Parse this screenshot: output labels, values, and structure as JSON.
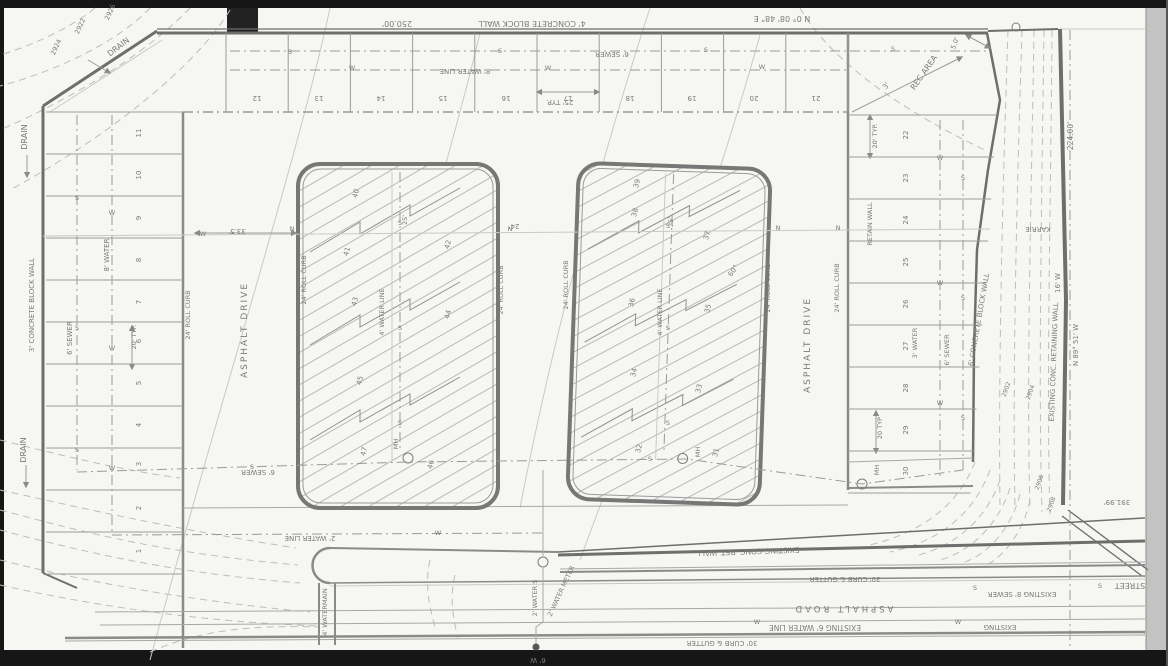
{
  "colors": {
    "paper": "#f6f6f3",
    "frame": "#161616",
    "margin": "#c3c3c3",
    "pencil": "#8c8c8c",
    "pencil_light": "#bdbdbd",
    "pencil_dark": "#5f5f5f"
  },
  "annotations": [
    {
      "id": "top-wall-label",
      "text": "4' CONCRETE BLOCK WALL",
      "x": 532,
      "y": 21,
      "r": 180,
      "s": 8
    },
    {
      "id": "top-wall-dim",
      "text": "250.00'",
      "x": 397,
      "y": 21,
      "r": 180,
      "s": 8
    },
    {
      "id": "top-bearing",
      "text": "N 0° 08' 48\" E",
      "x": 782,
      "y": 16,
      "r": 180,
      "s": 8
    },
    {
      "id": "top-sewer-label",
      "text": "6' SEWER",
      "x": 612,
      "y": 52,
      "r": 180,
      "s": 7
    },
    {
      "id": "top-water-label",
      "text": "8' WATER LINE",
      "x": 465,
      "y": 69,
      "r": 180,
      "s": 7
    },
    {
      "id": "top-dim-25typ",
      "text": "25' TYP.",
      "x": 560,
      "y": 100,
      "r": 180,
      "s": 7
    },
    {
      "id": "drain-nw-1",
      "text": "DRAIN",
      "x": 120,
      "y": 49,
      "r": -38,
      "s": 8
    },
    {
      "id": "drain-nw-2",
      "text": "DRAIN",
      "x": 27,
      "y": 137,
      "r": -90,
      "s": 8
    },
    {
      "id": "contour-2924",
      "text": "2924",
      "x": 58,
      "y": 48,
      "r": -65,
      "s": 6.5
    },
    {
      "id": "contour-2922",
      "text": "2922",
      "x": 82,
      "y": 27,
      "r": -65,
      "s": 6.5
    },
    {
      "id": "contour-2926",
      "text": "2926",
      "x": 112,
      "y": 13,
      "r": -65,
      "s": 6.5
    },
    {
      "id": "left-wall-label",
      "text": "3' CONCRETE BLOCK WALL",
      "x": 34,
      "y": 305,
      "r": -90,
      "s": 7
    },
    {
      "id": "left-sewer-label",
      "text": "6' SEWER",
      "x": 72,
      "y": 338,
      "r": -90,
      "s": 7
    },
    {
      "id": "left-water-label",
      "text": "8' WATER",
      "x": 109,
      "y": 255,
      "r": -90,
      "s": 7
    },
    {
      "id": "left-dim-20typ",
      "text": "20' TYP.",
      "x": 136,
      "y": 337,
      "r": -90,
      "s": 6.5
    },
    {
      "id": "drain-sw",
      "text": "DRAIN",
      "x": 26,
      "y": 450,
      "r": -90,
      "s": 8
    },
    {
      "id": "rec-area-label",
      "text": "REC AREA",
      "x": 926,
      "y": 74,
      "r": -55,
      "s": 8
    },
    {
      "id": "rec-dim-3",
      "text": "3'",
      "x": 888,
      "y": 87,
      "r": -55,
      "s": 7
    },
    {
      "id": "rec-dim-5",
      "text": "5.0'",
      "x": 957,
      "y": 44,
      "r": -70,
      "s": 6.5
    },
    {
      "id": "dim-224",
      "text": "224.00'",
      "x": 1073,
      "y": 136,
      "r": -90,
      "s": 7.5
    },
    {
      "id": "street-karrie",
      "text": "KARRIE",
      "x": 1038,
      "y": 227,
      "r": 180,
      "s": 7
    },
    {
      "id": "wall-6conc-label",
      "text": "6' CONCRETE BLOCK WALL",
      "x": 981,
      "y": 320,
      "r": -80,
      "s": 7
    },
    {
      "id": "ret-wall-ne-label",
      "text": "EXISTING CONC. RETAINING WALL",
      "x": 1056,
      "y": 362,
      "r": -88,
      "s": 7
    },
    {
      "id": "bearing-right",
      "text": "N 89° 51' W",
      "x": 1078,
      "y": 345,
      "r": -90,
      "s": 7
    },
    {
      "id": "dim-16w",
      "text": "16' W",
      "x": 1060,
      "y": 283,
      "r": -90,
      "s": 7
    },
    {
      "id": "contour-2902",
      "text": "2902",
      "x": 1008,
      "y": 390,
      "r": -70,
      "s": 6
    },
    {
      "id": "contour-2904",
      "text": "2904",
      "x": 1032,
      "y": 393,
      "r": -70,
      "s": 6
    },
    {
      "id": "right-water-label",
      "text": "3' WATER",
      "x": 917,
      "y": 343,
      "r": -90,
      "s": 6.5
    },
    {
      "id": "right-sewer-label",
      "text": "6' SEWER",
      "x": 949,
      "y": 350,
      "r": -90,
      "s": 6.5
    },
    {
      "id": "right-retain-label",
      "text": "RETAIN WALL",
      "x": 872,
      "y": 224,
      "r": -90,
      "s": 6.5
    },
    {
      "id": "right-dim-20a",
      "text": "20' TYP.",
      "x": 877,
      "y": 136,
      "r": -90,
      "s": 6.5
    },
    {
      "id": "right-dim-20b",
      "text": "20 TYP",
      "x": 882,
      "y": 428,
      "r": -90,
      "s": 6.5
    },
    {
      "id": "ret-wall-s-label",
      "text": "EXISTING CONC. RET. WALL",
      "x": 748,
      "y": 549,
      "r": 178,
      "s": 7.5
    },
    {
      "id": "curb-gutter-n",
      "text": "30' CURB & GUTTER",
      "x": 845,
      "y": 577,
      "r": 180,
      "s": 7
    },
    {
      "id": "asphalt-road-label",
      "text": "ASPHALT ROAD",
      "x": 843,
      "y": 606,
      "r": 180,
      "s": 8.5,
      "ls": 3
    },
    {
      "id": "exist-water-6",
      "text": "EXISTING 6' WATER LINE",
      "x": 815,
      "y": 625,
      "r": 180,
      "s": 7.5
    },
    {
      "id": "curb-gutter-s",
      "text": "30' CURB & GUTTER",
      "x": 722,
      "y": 641,
      "r": 180,
      "s": 7
    },
    {
      "id": "exist-sewer-8",
      "text": "EXISTING 8' SEWER",
      "x": 1022,
      "y": 592,
      "r": 180,
      "s": 7
    },
    {
      "id": "street-label",
      "text": "STREET",
      "x": 1130,
      "y": 583,
      "r": 180,
      "s": 8
    },
    {
      "id": "exist-w-label",
      "text": "EXISTING",
      "x": 1000,
      "y": 625,
      "r": 180,
      "s": 7
    },
    {
      "id": "dim-39199",
      "text": "391.99'",
      "x": 1117,
      "y": 500,
      "r": 180,
      "s": 7
    },
    {
      "id": "contour-2906",
      "text": "2906",
      "x": 1041,
      "y": 483,
      "r": -70,
      "s": 6
    },
    {
      "id": "contour-2908",
      "text": "2908",
      "x": 1053,
      "y": 505,
      "r": -70,
      "s": 6
    },
    {
      "id": "water-2-line",
      "text": "2' WATER LINE",
      "x": 310,
      "y": 536,
      "r": 180,
      "s": 7
    },
    {
      "id": "sewer-6-s",
      "text": "6' SEWER",
      "x": 258,
      "y": 470,
      "r": 180,
      "s": 7
    },
    {
      "id": "watermain-4",
      "text": "4' WATERMAIN",
      "x": 327,
      "y": 612,
      "r": -90,
      "s": 6.5
    },
    {
      "id": "water-2-s",
      "text": "2' WATER S",
      "x": 537,
      "y": 598,
      "r": -90,
      "s": 6.5
    },
    {
      "id": "water-meter-2",
      "text": "2' WATER METER",
      "x": 563,
      "y": 592,
      "r": -65,
      "s": 6.5
    },
    {
      "id": "tap-6w",
      "text": "6' W",
      "x": 538,
      "y": 658,
      "r": 180,
      "s": 7
    },
    {
      "id": "drive-west-label",
      "text": "ASPHALT DRIVE",
      "x": 247,
      "y": 330,
      "r": -90,
      "s": 9,
      "ls": 2
    },
    {
      "id": "drive-east-label",
      "text": "ASPHALT DRIVE",
      "x": 810,
      "y": 345,
      "r": -90,
      "s": 9,
      "ls": 2
    },
    {
      "id": "roll-curb-1",
      "text": "24' ROLL CURB",
      "x": 190,
      "y": 315,
      "r": -90,
      "s": 6.5
    },
    {
      "id": "roll-curb-2",
      "text": "24' ROLL CURB",
      "x": 306,
      "y": 280,
      "r": -90,
      "s": 6.5
    },
    {
      "id": "roll-curb-3",
      "text": "24' ROLL CURB",
      "x": 503,
      "y": 290,
      "r": -90,
      "s": 6.5
    },
    {
      "id": "roll-curb-4",
      "text": "24' ROLL CURB",
      "x": 568,
      "y": 285,
      "r": -90,
      "s": 6.5
    },
    {
      "id": "roll-curb-5",
      "text": "24' ROLL CURB",
      "x": 770,
      "y": 288,
      "r": -90,
      "s": 6.5
    },
    {
      "id": "roll-curb-6",
      "text": "24' ROLL CURB",
      "x": 839,
      "y": 288,
      "r": -90,
      "s": 6.5
    },
    {
      "id": "dim-335",
      "text": "33.5'",
      "x": 237,
      "y": 229,
      "r": 180,
      "s": 7
    },
    {
      "id": "dim-24",
      "text": "24'",
      "x": 514,
      "y": 224,
      "r": 180,
      "s": 7
    },
    {
      "id": "bldg-water-l",
      "text": "4' WATER LINE",
      "x": 384,
      "y": 312,
      "r": -90,
      "s": 6.5
    },
    {
      "id": "bldg-water-r",
      "text": "4' WATER LINE",
      "x": 662,
      "y": 312,
      "r": -90,
      "s": 6.5
    },
    {
      "id": "mh-1",
      "text": "MH",
      "x": 398,
      "y": 444,
      "r": -90,
      "s": 6.5
    },
    {
      "id": "mh-2",
      "text": "MH",
      "x": 700,
      "y": 452,
      "r": -90,
      "s": 6.5
    },
    {
      "id": "mh-3",
      "text": "MH",
      "x": 879,
      "y": 470,
      "r": -90,
      "s": 6.5
    },
    {
      "id": "angle-60",
      "text": "60°",
      "x": 735,
      "y": 272,
      "r": -55,
      "s": 7
    },
    {
      "id": "dim-25-bldg-l",
      "text": "25'",
      "x": 407,
      "y": 220,
      "r": -90,
      "s": 6.5
    },
    {
      "id": "dim-25-bldg-r",
      "text": "25'",
      "x": 673,
      "y": 222,
      "r": -90,
      "s": 6.5
    }
  ],
  "parking": {
    "left_stalls": [
      {
        "id": "stall-11",
        "text": "11",
        "x": 141,
        "y": 133,
        "r": -90,
        "s": 7
      },
      {
        "id": "stall-10",
        "text": "10",
        "x": 141,
        "y": 175,
        "r": -90,
        "s": 7
      },
      {
        "id": "stall-9",
        "text": "9",
        "x": 141,
        "y": 218,
        "r": -90,
        "s": 7
      },
      {
        "id": "stall-8",
        "text": "8",
        "x": 141,
        "y": 260,
        "r": -90,
        "s": 7
      },
      {
        "id": "stall-7",
        "text": "7",
        "x": 141,
        "y": 302,
        "r": -90,
        "s": 7
      },
      {
        "id": "stall-6",
        "text": "6",
        "x": 141,
        "y": 341,
        "r": -90,
        "s": 7
      },
      {
        "id": "stall-5",
        "text": "5",
        "x": 141,
        "y": 383,
        "r": -90,
        "s": 7
      },
      {
        "id": "stall-4",
        "text": "4",
        "x": 141,
        "y": 425,
        "r": -90,
        "s": 7
      },
      {
        "id": "stall-3",
        "text": "3",
        "x": 141,
        "y": 464,
        "r": -90,
        "s": 7
      },
      {
        "id": "stall-2",
        "text": "2",
        "x": 141,
        "y": 508,
        "r": -90,
        "s": 7
      },
      {
        "id": "stall-1",
        "text": "1",
        "x": 141,
        "y": 551,
        "r": -90,
        "s": 7
      }
    ],
    "top_stalls": [
      {
        "id": "stall-12",
        "text": "12",
        "x": 257,
        "y": 96,
        "r": 180,
        "s": 7
      },
      {
        "id": "stall-13",
        "text": "13",
        "x": 319,
        "y": 96,
        "r": 180,
        "s": 7
      },
      {
        "id": "stall-14",
        "text": "14",
        "x": 381,
        "y": 96,
        "r": 180,
        "s": 7
      },
      {
        "id": "stall-15",
        "text": "15",
        "x": 443,
        "y": 96,
        "r": 180,
        "s": 7
      },
      {
        "id": "stall-16",
        "text": "16",
        "x": 506,
        "y": 96,
        "r": 180,
        "s": 7
      },
      {
        "id": "stall-17",
        "text": "17",
        "x": 568,
        "y": 96,
        "r": 180,
        "s": 7
      },
      {
        "id": "stall-18",
        "text": "18",
        "x": 630,
        "y": 96,
        "r": 180,
        "s": 7
      },
      {
        "id": "stall-19",
        "text": "19",
        "x": 692,
        "y": 96,
        "r": 180,
        "s": 7
      },
      {
        "id": "stall-20",
        "text": "20",
        "x": 754,
        "y": 96,
        "r": 180,
        "s": 7
      },
      {
        "id": "stall-21",
        "text": "21",
        "x": 816,
        "y": 96,
        "r": 180,
        "s": 7
      }
    ],
    "right_stalls": [
      {
        "id": "stall-22",
        "text": "22",
        "x": 908,
        "y": 135,
        "r": -90,
        "s": 7
      },
      {
        "id": "stall-23",
        "text": "23",
        "x": 908,
        "y": 178,
        "r": -90,
        "s": 7
      },
      {
        "id": "stall-24",
        "text": "24",
        "x": 908,
        "y": 220,
        "r": -90,
        "s": 7
      },
      {
        "id": "stall-25",
        "text": "25",
        "x": 908,
        "y": 262,
        "r": -90,
        "s": 7
      },
      {
        "id": "stall-26",
        "text": "26",
        "x": 908,
        "y": 304,
        "r": -90,
        "s": 7
      },
      {
        "id": "stall-27",
        "text": "27",
        "x": 908,
        "y": 346,
        "r": -90,
        "s": 7
      },
      {
        "id": "stall-28",
        "text": "28",
        "x": 908,
        "y": 388,
        "r": -90,
        "s": 7
      },
      {
        "id": "stall-29",
        "text": "29",
        "x": 908,
        "y": 430,
        "r": -90,
        "s": 7
      },
      {
        "id": "stall-30",
        "text": "30",
        "x": 908,
        "y": 471,
        "r": -90,
        "s": 7
      }
    ]
  },
  "buildings": {
    "left_units": [
      {
        "id": "unit-40",
        "text": "40",
        "x": 358,
        "y": 194,
        "r": -75,
        "s": 7
      },
      {
        "id": "unit-41",
        "text": "41",
        "x": 349,
        "y": 252,
        "r": -75,
        "s": 7
      },
      {
        "id": "unit-42",
        "text": "42",
        "x": 450,
        "y": 245,
        "r": -75,
        "s": 7
      },
      {
        "id": "unit-43",
        "text": "43",
        "x": 357,
        "y": 302,
        "r": -75,
        "s": 7
      },
      {
        "id": "unit-44",
        "text": "44",
        "x": 450,
        "y": 315,
        "r": -75,
        "s": 7
      },
      {
        "id": "unit-45",
        "text": "45",
        "x": 362,
        "y": 381,
        "r": -75,
        "s": 7
      },
      {
        "id": "unit-46",
        "text": "46",
        "x": 433,
        "y": 465,
        "r": -75,
        "s": 7
      },
      {
        "id": "unit-47",
        "text": "47",
        "x": 366,
        "y": 452,
        "r": -75,
        "s": 7
      }
    ],
    "right_units": [
      {
        "id": "unit-39",
        "text": "39",
        "x": 639,
        "y": 184,
        "r": -75,
        "s": 7
      },
      {
        "id": "unit-38",
        "text": "38",
        "x": 637,
        "y": 213,
        "r": -75,
        "s": 7
      },
      {
        "id": "unit-37",
        "text": "37",
        "x": 709,
        "y": 236,
        "r": -75,
        "s": 7
      },
      {
        "id": "unit-36",
        "text": "36",
        "x": 634,
        "y": 303,
        "r": -75,
        "s": 7
      },
      {
        "id": "unit-35",
        "text": "35",
        "x": 710,
        "y": 309,
        "r": -75,
        "s": 7
      },
      {
        "id": "unit-34",
        "text": "34",
        "x": 636,
        "y": 373,
        "r": -75,
        "s": 7
      },
      {
        "id": "unit-33",
        "text": "33",
        "x": 701,
        "y": 389,
        "r": -75,
        "s": 7
      },
      {
        "id": "unit-32",
        "text": "32",
        "x": 641,
        "y": 449,
        "r": -75,
        "s": 7
      },
      {
        "id": "unit-31",
        "text": "31",
        "x": 718,
        "y": 453,
        "r": -75,
        "s": 7
      }
    ]
  },
  "line_markers": [
    {
      "glyph": "S",
      "x": 290,
      "y": 54
    },
    {
      "glyph": "S",
      "x": 500,
      "y": 53
    },
    {
      "glyph": "S",
      "x": 706,
      "y": 52
    },
    {
      "glyph": "S",
      "x": 893,
      "y": 51
    },
    {
      "glyph": "S",
      "x": 77,
      "y": 200
    },
    {
      "glyph": "S",
      "x": 77,
      "y": 330
    },
    {
      "glyph": "S",
      "x": 77,
      "y": 452
    },
    {
      "glyph": "S",
      "x": 963,
      "y": 180
    },
    {
      "glyph": "S",
      "x": 963,
      "y": 300
    },
    {
      "glyph": "S",
      "x": 963,
      "y": 420
    },
    {
      "glyph": "S",
      "x": 400,
      "y": 225
    },
    {
      "glyph": "S",
      "x": 400,
      "y": 330
    },
    {
      "glyph": "S",
      "x": 400,
      "y": 425
    },
    {
      "glyph": "S",
      "x": 668,
      "y": 228
    },
    {
      "glyph": "S",
      "x": 668,
      "y": 330
    },
    {
      "glyph": "S",
      "x": 668,
      "y": 425
    },
    {
      "glyph": "S",
      "x": 252,
      "y": 469
    },
    {
      "glyph": "S",
      "x": 650,
      "y": 461
    },
    {
      "glyph": "S",
      "x": 975,
      "y": 590
    },
    {
      "glyph": "S",
      "x": 1100,
      "y": 588
    },
    {
      "glyph": "W",
      "x": 352,
      "y": 70
    },
    {
      "glyph": "W",
      "x": 548,
      "y": 70
    },
    {
      "glyph": "W",
      "x": 762,
      "y": 69
    },
    {
      "glyph": "W",
      "x": 112,
      "y": 215
    },
    {
      "glyph": "W",
      "x": 112,
      "y": 350
    },
    {
      "glyph": "W",
      "x": 112,
      "y": 470
    },
    {
      "glyph": "W",
      "x": 940,
      "y": 160
    },
    {
      "glyph": "W",
      "x": 940,
      "y": 285
    },
    {
      "glyph": "W",
      "x": 940,
      "y": 405
    },
    {
      "glyph": "W",
      "x": 438,
      "y": 535
    },
    {
      "glyph": "W",
      "x": 757,
      "y": 624
    },
    {
      "glyph": "W",
      "x": 958,
      "y": 624
    },
    {
      "glyph": "W",
      "x": 203,
      "y": 236
    },
    {
      "glyph": "N",
      "x": 292,
      "y": 231
    },
    {
      "glyph": "N",
      "x": 510,
      "y": 231
    },
    {
      "glyph": "N",
      "x": 778,
      "y": 230
    },
    {
      "glyph": "N",
      "x": 838,
      "y": 230
    }
  ]
}
